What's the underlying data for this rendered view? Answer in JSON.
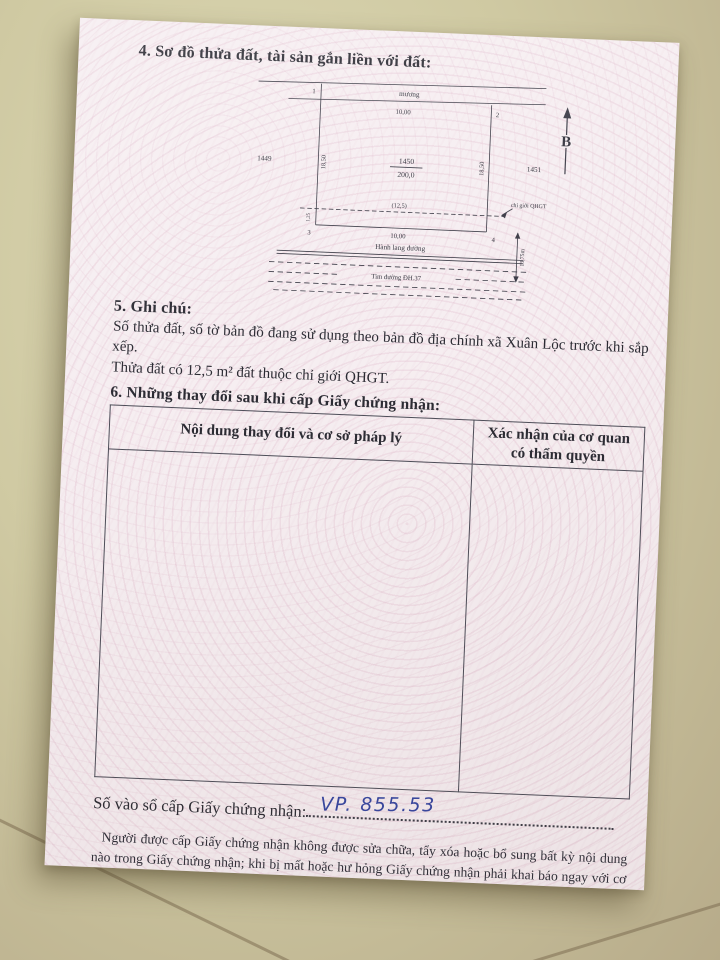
{
  "colors": {
    "floor": "#cfc9a2",
    "paper": "#f6eef1",
    "guilloche_pink": "#e0bacb",
    "ink": "#2b2b33",
    "handwriting_blue": "#3646a0"
  },
  "section4": {
    "title": "4. Sơ đồ thửa đất, tài sản gắn liền với đất:"
  },
  "diagram": {
    "north_label": "B",
    "canal_label": "mương",
    "corner_1": "1",
    "corner_2": "2",
    "corner_3": "3",
    "corner_4": "4",
    "top_width": "10,00",
    "bottom_width": "10,00",
    "left_length": "18,50",
    "right_length": "18,50",
    "parcel_left": "1449",
    "parcel_right": "1451",
    "plot_number": "1450",
    "plot_area": "200,0",
    "qhgt_width": "(12,5)",
    "strip_depth": "1,25",
    "qhgt_line_label": "chỉ giới QHGT",
    "corridor_label": "Hành lang đường",
    "centerline_label": "Tim đường ĐH.37",
    "road_half_width": "13,75m"
  },
  "section5": {
    "title": "5. Ghi chú:",
    "line1": "Số thửa đất, số tờ bản đồ đang sử dụng theo bản đồ địa chính xã Xuân Lộc trước khi sắp xếp.",
    "line2": "Thửa đất có 12,5 m² đất thuộc chỉ giới QHGT."
  },
  "section6": {
    "title": "6. Những thay đổi sau khi cấp Giấy chứng nhận:",
    "col1_header": "Nội dung thay đổi và cơ sở pháp lý",
    "col2_header": "Xác nhận của cơ quan có thẩm quyền"
  },
  "registry": {
    "label": "Số vào sổ cấp Giấy chứng nhận:",
    "value": "VP. 855.53"
  },
  "footer": {
    "text": "Người được cấp Giấy chứng nhận không được sửa chữa, tẩy xóa hoặc bổ sung bất kỳ nội dung nào trong Giấy chứng nhận; khi bị mất hoặc hư hỏng Giấy chứng nhận phải khai báo ngay với cơ quan cấp Giấy."
  }
}
